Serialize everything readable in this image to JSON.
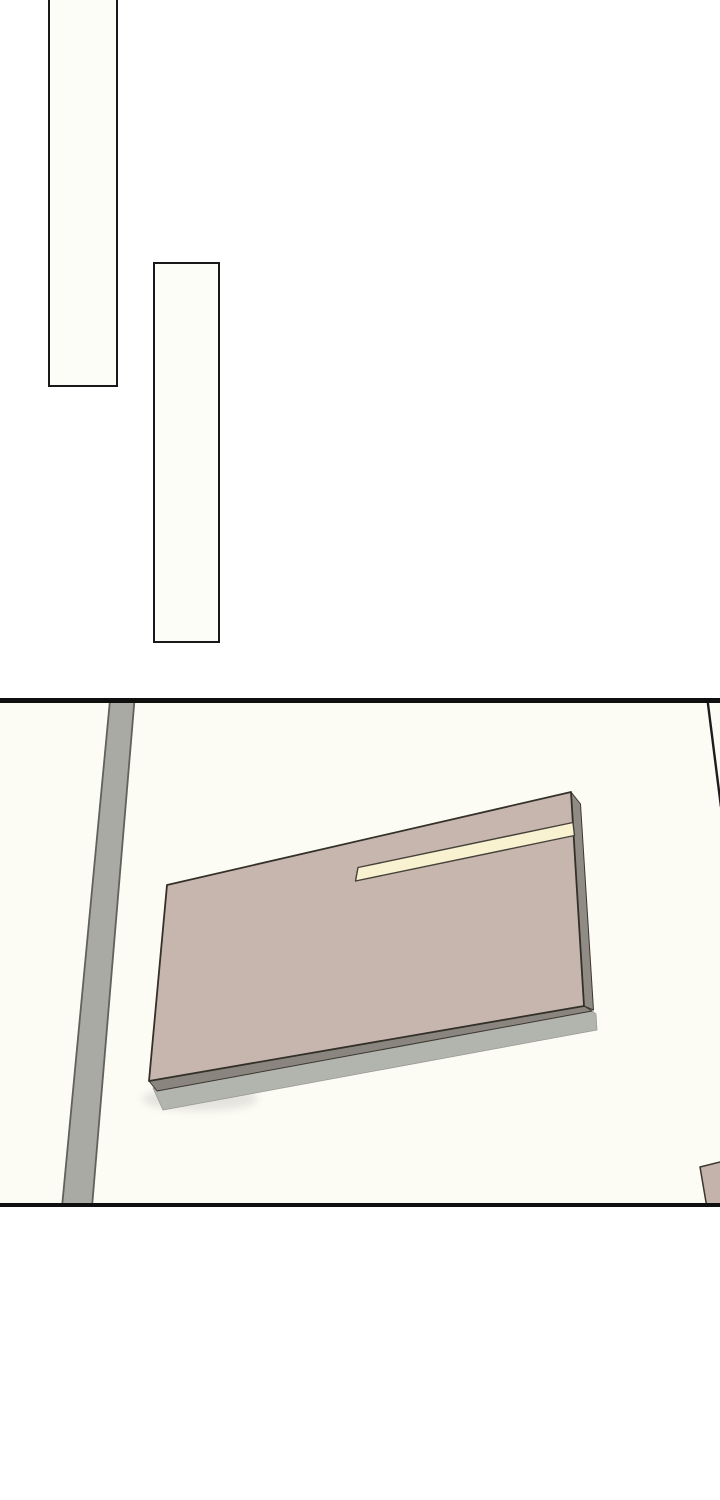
{
  "page": {
    "kind": "webtoon-comic-page",
    "width": 720,
    "height": 1500,
    "background": "#ffffff",
    "text_content": "none"
  },
  "colors": {
    "page_background": "#ffffff",
    "panel_line": "#0f0f0f",
    "scene_background": "#fcfcf4",
    "desk_top": "#c6b6ad",
    "desk_side": "#908b84",
    "desk_front": "#8a857e",
    "desk_base": "#b2b4ae",
    "ruler_strip": "#f8f2d0",
    "road_fill": "#a9aaa4",
    "road_edge": "#61615b",
    "outline_dark": "#332f29"
  },
  "empty_panels": [
    {
      "name": "empty-vertical-panel-1",
      "x": 48,
      "y": -3,
      "width": 70,
      "height": 390,
      "fill": "#fdfdf8",
      "border_color": "#191919",
      "border_width": 2.5,
      "note": "top edge cropped by page top"
    },
    {
      "name": "empty-vertical-panel-2",
      "x": 153,
      "y": 262,
      "width": 67,
      "height": 381,
      "fill": "#fdfdf8",
      "border_color": "#191919",
      "border_width": 2.5
    }
  ],
  "scene_panel": {
    "name": "scene-panel",
    "y": 698,
    "height": 509,
    "background": "#fcfcf4",
    "border_color": "#0f0f0f",
    "border_top_width": 5,
    "border_bottom_width": 4,
    "shapes": [
      {
        "type": "polygon",
        "name": "road-strip",
        "points": "110,700 134.5,700 92,1207 62,1207",
        "fill": "#a9aaa4",
        "stroke": "#61615b",
        "stroke_width": 1.8
      },
      {
        "type": "polyline",
        "name": "adjacent-panel-edge-line",
        "points": "707.5,700 721,807",
        "fill": "none",
        "stroke": "#1c1c1c",
        "stroke_width": 2.4
      },
      {
        "type": "ellipse",
        "name": "desk-shadow",
        "cx": 200,
        "cy": 1099,
        "rx": 58,
        "ry": 12,
        "fill": "#dddcd6",
        "opacity": 0.75,
        "blur": true
      },
      {
        "type": "polygon",
        "name": "desk-base-edge",
        "points": "153,1088 590,1009 596,1014 597,1030 163,1110",
        "fill": "#b2b4ae",
        "stroke": "#9a9a93",
        "stroke_width": 0.8
      },
      {
        "type": "polygon",
        "name": "desk-front-edge",
        "points": "149,1081 584,1006 592,1011 157,1091",
        "fill": "#8a857e",
        "stroke": "#3b372f",
        "stroke_width": 1
      },
      {
        "type": "polygon",
        "name": "desk-right-edge",
        "points": "571,792 580.5,804 593.5,1010 584,1006",
        "fill": "#908b84",
        "stroke": "#3b372f",
        "stroke_width": 1
      },
      {
        "type": "polygon",
        "name": "desk-top-surface",
        "points": "167,885 571,792 584,1006 149,1081",
        "fill": "#c6b6ad",
        "stroke": "#332f29",
        "stroke_width": 1.8
      },
      {
        "type": "polygon",
        "name": "ruler-strip",
        "points": "358,867.5 573,822.5 574.5,835.5 355.5,881",
        "fill": "#f8f2d0",
        "stroke": "#45403a",
        "stroke_width": 1.4
      },
      {
        "type": "polygon",
        "name": "corner-object",
        "points": "700,1167 722,1161.5 722,1205 706.5,1205",
        "fill": "#c4b3aa",
        "stroke": "#3a352f",
        "stroke_width": 1.5
      }
    ]
  }
}
